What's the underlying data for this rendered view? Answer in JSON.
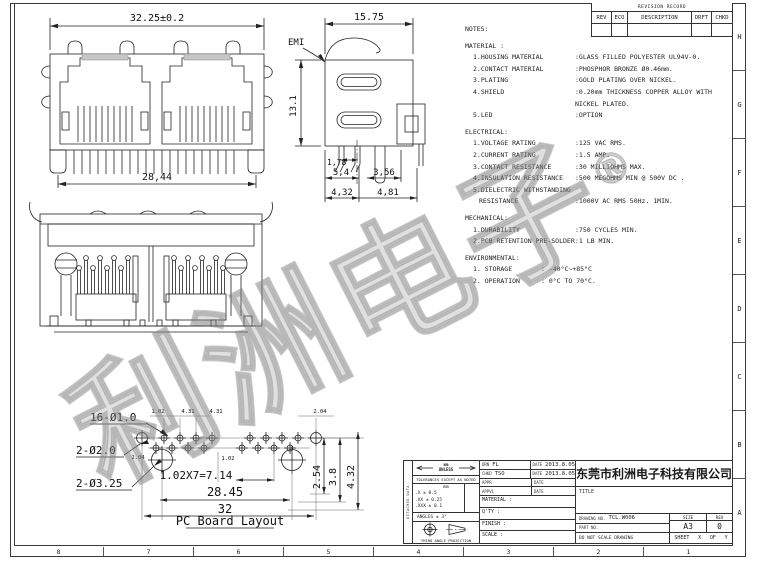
{
  "border": {
    "right_letters": [
      "H",
      "G",
      "F",
      "E",
      "D",
      "C",
      "B",
      "A"
    ],
    "bottom_numbers": [
      "8",
      "7",
      "6",
      "5",
      "4",
      "3",
      "2",
      "1"
    ]
  },
  "revision_table": {
    "title": "REVISION RECORD",
    "columns": [
      "REV",
      "ECO",
      "DESCRIPTION",
      "DRFT",
      "CHKD"
    ]
  },
  "watermark": {
    "text": "利洲电子",
    "reg": "®"
  },
  "notes": {
    "heading": "NOTES:",
    "material": {
      "title": "MATERIAL :",
      "items": [
        {
          "label": "1.HOUSING MATERIAL",
          "value": ":GLASS FILLED POLYESTER UL94V-0."
        },
        {
          "label": "2.CONTACT MATERIAL",
          "value": ":PHOSPHOR BRONZE Ø0.46mm."
        },
        {
          "label": "3.PLATING",
          "value": ":GOLD PLATING OVER NICKEL."
        },
        {
          "label": "4.SHIELD",
          "value": ":0.20mm THICKNESS COPPER ALLOY WITH NICKEL PLATED."
        },
        {
          "label": "5.LED",
          "value": ":OPTION"
        }
      ]
    },
    "electrical": {
      "title": "ELECTRICAL:",
      "items": [
        {
          "label": "1.VOLTAGE RATING",
          "value": ":125 VAC RMS."
        },
        {
          "label": "2.CURRENT RATING",
          "value": ":1.5 AMP."
        },
        {
          "label": "3.CONTACT RESISTANCE",
          "value": ":30 MILLIOHMS MAX."
        },
        {
          "label": "4.INSULATION RESISTANCE",
          "value": ":500 MEGOHMS MIN @ 500V DC ."
        },
        {
          "label": "5.DIELECTRIC WITHSTANDING",
          "label2": "RESISTANCE",
          "value": ":1000V AC RMS 50Hz. 1MIN."
        }
      ]
    },
    "mechanical": {
      "title": "MECHANICAL:",
      "items": [
        {
          "label": "1.DURABILITY",
          "value": ":750 CYCLES MIN."
        },
        {
          "label": "2.PCB RETENTION PRE-SOLDER",
          "value": ":1 LB MIN."
        }
      ]
    },
    "environmental": {
      "title": "ENVIRONMENTAL:",
      "items": [
        {
          "label": "1. STORAGE",
          "value": ": -40°C~+85°C"
        },
        {
          "label": "2. OPERATION",
          "value": ": 0°C TO 70°C."
        }
      ]
    }
  },
  "views": {
    "front": {
      "dim_width_top": "32.25±0.2",
      "dim_width_bottom": "28,44"
    },
    "side": {
      "dim_width": "15.75",
      "emi_label": "EMI",
      "dim_height": "13.1",
      "dim_pitch": "1,78",
      "dim_a": "5,4",
      "dim_b": "3,56",
      "dim_c": "4,32",
      "dim_d": "4,81"
    },
    "pcb": {
      "title": "PC Board Layout",
      "label_small_holes": "16-Ø1.0",
      "label_mid_holes": "2-Ø2.0",
      "label_big_holes": "2-Ø3.25",
      "dim_pitch": "1.02X7=7.14",
      "dim_span": "28.45",
      "dim_total": "32",
      "dim_v1": "2.54",
      "dim_v2": "3.8",
      "dim_v3": "4.32",
      "dim_t1": "1.02",
      "dim_t2": "4.31",
      "dim_t3": "4.31",
      "dim_t4": "2.04",
      "dim_m1": "2.04",
      "dim_m2": "1.02"
    }
  },
  "title_block": {
    "signoff": [
      {
        "role": "DRN",
        "name": "FL",
        "date_label": "DATE",
        "date": "2013.8.05"
      },
      {
        "role": "CHKD",
        "name": "TSO",
        "date_label": "DATE",
        "date": "2013.8.05"
      },
      {
        "role": "APPR",
        "name": "",
        "date_label": "DATE",
        "date": ""
      },
      {
        "role": "APPVL",
        "name": "",
        "date_label": "DATE",
        "date": ""
      }
    ],
    "material_label": "MATERIAL :",
    "qty_label": "Q'TY :",
    "finish_label": "FINISH :",
    "scale_label": "SCALE :",
    "tolerance": {
      "units_top": "mm",
      "units_bottom": "UNLESS",
      "note": "TOLERANCES EXCEPT AS NOTED",
      "col_header": "mm",
      "row1": ".X ± 0.5",
      "row2": ".XX ± 0.25",
      "row3": ".XXX ± 0.1",
      "angles": "ANGLES ± 3°",
      "projection": "THIRD ANGLE PROJECTION",
      "side_label": "DETACHED DATA"
    },
    "company": "东莞市利洲电子科技有限公司",
    "title_label": "TITLE",
    "drawing_no_label": "DRAWING NO.",
    "drawing_no": "TCL.W006",
    "part_no_label": "PART NO.",
    "size_label": "SIZE",
    "size": "A3",
    "rev_label": "REV",
    "rev": "0",
    "no_scale": "DO NOT SCALE DRAWING",
    "sheet_label": "SHEET",
    "sheet_x": "X",
    "of_label": "OF",
    "sheet_y": "Y"
  }
}
